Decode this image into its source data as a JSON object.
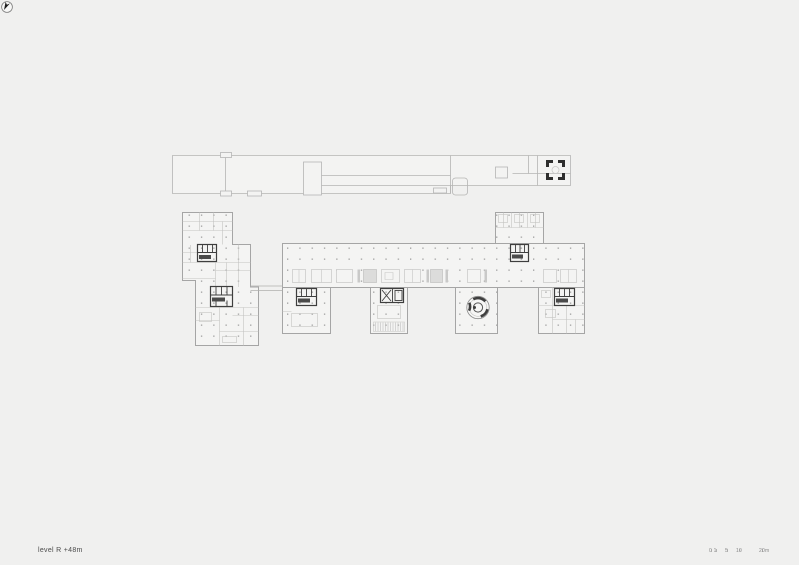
{
  "drawing": {
    "title": "level R +48m",
    "level": "R",
    "elevation": "+48m",
    "type": "architectural floor plan sheet",
    "parts": [
      "upper-strip-drawing",
      "left-tower",
      "main-slab",
      "lower-wing-a",
      "lower-wing-b",
      "lower-wing-c",
      "upper-tower-d",
      "right-tower-e"
    ]
  },
  "scale_bar": {
    "labels": [
      "0 1",
      "5",
      "10",
      "20m"
    ]
  },
  "icons": {
    "north_arrow": "north-arrow-icon",
    "corner_marker": "crane-target-marker-icon",
    "spiral_stair": "spiral-stair-icon",
    "elevator_core": "elevator-core-icon"
  },
  "colors": {
    "background": "#f0f0ef",
    "floor_fill": "#f4f4f3",
    "outline": "#a5a5a5",
    "interior_line": "#c3c3c2",
    "core_dark": "#3e3e3e",
    "text": "#4a4a4a"
  }
}
